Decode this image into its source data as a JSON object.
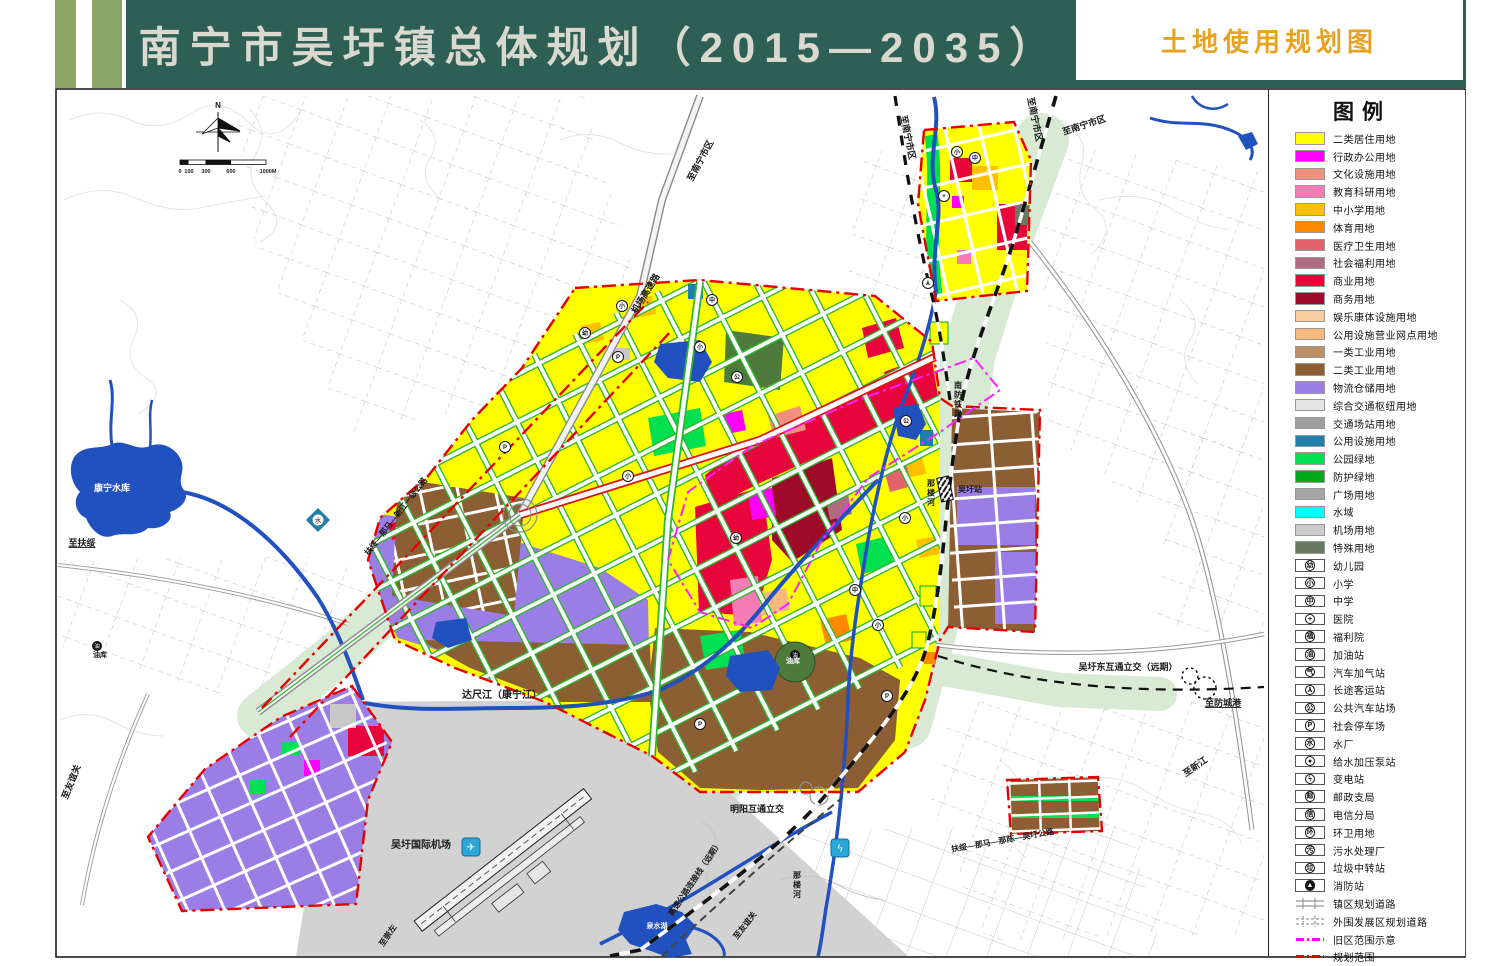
{
  "header": {
    "title": "南宁市吴圩镇总体规划（2015—2035）",
    "sheet_label": "土地使用规划图",
    "bar_color": "#2E5F55",
    "stripe_color": "#8BA566",
    "title_color": "#D9D9CF",
    "sheet_label_color": "#E8A21E"
  },
  "legend": {
    "title": "图例",
    "items": [
      {
        "label": "二类居住用地",
        "color": "#FFFF00"
      },
      {
        "label": "行政办公用地",
        "color": "#FF00FF"
      },
      {
        "label": "文化设施用地",
        "color": "#F0907E"
      },
      {
        "label": "教育科研用地",
        "color": "#F57CB4"
      },
      {
        "label": "中小学用地",
        "color": "#FFC000"
      },
      {
        "label": "体育用地",
        "color": "#FF8A00"
      },
      {
        "label": "医疗卫生用地",
        "color": "#E2636B"
      },
      {
        "label": "社会福利用地",
        "color": "#B26B80"
      },
      {
        "label": "商业用地",
        "color": "#E8053C"
      },
      {
        "label": "商务用地",
        "color": "#9E0B28"
      },
      {
        "label": "娱乐康体设施用地",
        "color": "#F9CD9D"
      },
      {
        "label": "公用设施营业网点用地",
        "color": "#F7B97E"
      },
      {
        "label": "一类工业用地",
        "color": "#BE9066"
      },
      {
        "label": "二类工业用地",
        "color": "#8B5E34"
      },
      {
        "label": "物流仓储用地",
        "color": "#9A7EE6"
      },
      {
        "label": "综合交通枢纽用地",
        "color": "#E4E4E4"
      },
      {
        "label": "交通场站用地",
        "color": "#9E9E9E"
      },
      {
        "label": "公用设施用地",
        "color": "#1F7FA6"
      },
      {
        "label": "公园绿地",
        "color": "#00E050"
      },
      {
        "label": "防护绿地",
        "color": "#00A81C"
      },
      {
        "label": "广场用地",
        "color": "#A6A6A6"
      },
      {
        "label": "水域",
        "color": "#00FFFF"
      },
      {
        "label": "机场用地",
        "color": "#CCCCCC"
      },
      {
        "label": "特殊用地",
        "color": "#6A7A62"
      },
      {
        "label": "幼儿园",
        "glyph": "幼",
        "icon_name": "kindergarten-icon"
      },
      {
        "label": "小学",
        "glyph": "小",
        "icon_name": "primary-school-icon"
      },
      {
        "label": "中学",
        "glyph": "中",
        "icon_name": "middle-school-icon"
      },
      {
        "label": "医院",
        "glyph": "+",
        "icon_name": "hospital-icon"
      },
      {
        "label": "福利院",
        "glyph": "福",
        "icon_name": "welfare-house-icon"
      },
      {
        "label": "加油站",
        "glyph": "油",
        "icon_name": "gas-station-icon"
      },
      {
        "label": "汽车加气站",
        "glyph": "气",
        "icon_name": "cng-station-icon"
      },
      {
        "label": "长途客运站",
        "glyph": "⅄",
        "icon_name": "coach-station-icon"
      },
      {
        "label": "公共汽车站场",
        "glyph": "公",
        "icon_name": "bus-station-icon"
      },
      {
        "label": "社会停车场",
        "glyph": "P",
        "icon_name": "parking-icon"
      },
      {
        "label": "水厂",
        "glyph": "水",
        "icon_name": "water-plant-icon"
      },
      {
        "label": "给水加压泵站",
        "glyph": "●",
        "icon_name": "pump-station-icon"
      },
      {
        "label": "变电站",
        "glyph": "ϟ",
        "icon_name": "substation-icon"
      },
      {
        "label": "邮政支局",
        "glyph": "邮",
        "icon_name": "post-office-icon"
      },
      {
        "label": "电信分局",
        "glyph": "信",
        "icon_name": "telecom-office-icon"
      },
      {
        "label": "环卫用地",
        "glyph": "环",
        "icon_name": "sanitation-icon"
      },
      {
        "label": "污水处理厂",
        "glyph": "污",
        "icon_name": "sewage-plant-icon"
      },
      {
        "label": "垃圾中转站",
        "glyph": "垃",
        "icon_name": "garbage-transfer-icon"
      },
      {
        "label": "消防站",
        "glyph": "▲",
        "style": "filled",
        "icon_name": "fire-station-icon"
      },
      {
        "label": "镇区规划道路",
        "type": "road-solid",
        "icon_name": "town-road-swatch"
      },
      {
        "label": "外围发展区规划道路",
        "type": "road-dashed",
        "icon_name": "outer-road-swatch"
      },
      {
        "label": "旧区范围示意",
        "type": "dashdot",
        "color": "#FF00FF",
        "icon_name": "old-district-line"
      },
      {
        "label": "规划范围",
        "type": "dashdot",
        "color": "#E60000",
        "icon_name": "planning-boundary-line"
      }
    ]
  },
  "map": {
    "labels": [
      {
        "t": "N",
        "x": 218,
        "y": 108,
        "fs": 8,
        "b": 1
      },
      {
        "t": "0",
        "x": 180,
        "y": 173,
        "fs": 5.5
      },
      {
        "t": "100",
        "x": 189,
        "y": 173,
        "fs": 5.5
      },
      {
        "t": "300",
        "x": 206,
        "y": 173,
        "fs": 5.5
      },
      {
        "t": "600",
        "x": 231,
        "y": 173,
        "fs": 5.5
      },
      {
        "t": "1000M",
        "x": 268,
        "y": 173,
        "fs": 5.5
      },
      {
        "t": "至南宁市区",
        "x": 703,
        "y": 162,
        "rot": -62,
        "fs": 9
      },
      {
        "t": "至南宁市区",
        "x": 905,
        "y": 138,
        "rot": 78,
        "fs": 9
      },
      {
        "t": "至南宁市区",
        "x": 1032,
        "y": 120,
        "rot": 78,
        "fs": 9
      },
      {
        "t": "至南宁市区",
        "x": 1085,
        "y": 128,
        "rot": -18,
        "fs": 9
      },
      {
        "t": "机场高速路",
        "x": 648,
        "y": 295,
        "rot": -58,
        "fs": 9
      },
      {
        "t": "至扶绥",
        "x": 82,
        "y": 546,
        "fs": 9,
        "ul": 1
      },
      {
        "t": "康宁水库",
        "x": 112,
        "y": 491,
        "fs": 9,
        "fill": "#ffffff"
      },
      {
        "t": "油库",
        "x": 100,
        "y": 657,
        "fs": 7
      },
      {
        "t": "油库",
        "x": 793,
        "y": 663,
        "fs": 7,
        "fill": "#ffffff"
      },
      {
        "t": "至友谊关",
        "x": 74,
        "y": 783,
        "rot": -68,
        "fs": 9
      },
      {
        "t": "至友谊关",
        "x": 747,
        "y": 927,
        "rot": -52,
        "fs": 8
      },
      {
        "t": "达尺江（康宁江）",
        "x": 502,
        "y": 698,
        "fs": 10
      },
      {
        "t": "吴圩国际机场",
        "x": 421,
        "y": 848,
        "fs": 10
      },
      {
        "t": "吴圩站",
        "x": 970,
        "y": 492,
        "fs": 8
      },
      {
        "t": "南防铁路",
        "x": 958,
        "y": 388,
        "v": 1,
        "fs": 8
      },
      {
        "t": "那楼河",
        "x": 931,
        "y": 486,
        "v": 1,
        "fs": 8
      },
      {
        "t": "那楼河",
        "x": 797,
        "y": 878,
        "v": 1,
        "fs": 8
      },
      {
        "t": "吴圩东互通立交（远期）",
        "x": 1128,
        "y": 670,
        "fs": 9
      },
      {
        "t": "至防城港",
        "x": 1223,
        "y": 706,
        "fs": 9,
        "ul": 1
      },
      {
        "t": "至新江",
        "x": 1197,
        "y": 769,
        "rot": -35,
        "fs": 9
      },
      {
        "t": "明阳互通立交",
        "x": 757,
        "y": 812,
        "fs": 9
      },
      {
        "t": "高速公路连接线（远期）",
        "x": 697,
        "y": 880,
        "rot": -56,
        "fs": 8
      },
      {
        "t": "扶绥—那马—新江一级公路",
        "x": 398,
        "y": 518,
        "rot": -52,
        "fs": 8
      },
      {
        "t": "扶绥—那马—那陈—吴圩公路",
        "x": 1003,
        "y": 843,
        "rot": -10,
        "fs": 8
      },
      {
        "t": "至崇左",
        "x": 390,
        "y": 937,
        "rot": -56,
        "fs": 8
      },
      {
        "t": "泉水湖",
        "x": 657,
        "y": 928,
        "fs": 7,
        "fill": "#ffffff"
      }
    ],
    "icons": [
      {
        "g": "幼",
        "x": 585,
        "y": 333,
        "n": "kindergarten-icon"
      },
      {
        "g": "小",
        "x": 622,
        "y": 306,
        "n": "primary-school-icon"
      },
      {
        "g": "中",
        "x": 712,
        "y": 300,
        "n": "middle-school-icon"
      },
      {
        "g": "小",
        "x": 700,
        "y": 347,
        "n": "primary-school-icon"
      },
      {
        "g": "公",
        "x": 737,
        "y": 377,
        "n": "bus-station-icon"
      },
      {
        "g": "P",
        "x": 618,
        "y": 357,
        "n": "parking-icon"
      },
      {
        "g": "P",
        "x": 505,
        "y": 447,
        "n": "parking-icon"
      },
      {
        "g": "小",
        "x": 628,
        "y": 476,
        "n": "primary-school-icon"
      },
      {
        "g": "幼",
        "x": 736,
        "y": 538,
        "n": "kindergarten-icon"
      },
      {
        "g": "中",
        "x": 855,
        "y": 590,
        "n": "middle-school-icon"
      },
      {
        "g": "小",
        "x": 905,
        "y": 518,
        "n": "primary-school-icon"
      },
      {
        "g": "小",
        "x": 878,
        "y": 625,
        "n": "primary-school-icon"
      },
      {
        "g": "P",
        "x": 700,
        "y": 724,
        "n": "parking-icon"
      },
      {
        "g": "P",
        "x": 887,
        "y": 696,
        "n": "parking-icon"
      },
      {
        "g": "公",
        "x": 906,
        "y": 421,
        "n": "bus-station-icon"
      },
      {
        "g": "+",
        "x": 944,
        "y": 196,
        "n": "hospital-icon"
      },
      {
        "g": "小",
        "x": 957,
        "y": 152,
        "n": "primary-school-icon"
      },
      {
        "g": "中",
        "x": 975,
        "y": 158,
        "n": "middle-school-icon"
      },
      {
        "g": "⅄",
        "x": 928,
        "y": 283,
        "n": "coach-station-icon"
      },
      {
        "g": "油",
        "x": 795,
        "y": 655,
        "st": "f",
        "n": "oil-depot-icon"
      },
      {
        "g": "油",
        "x": 97,
        "y": 646,
        "st": "f",
        "n": "oil-depot-icon"
      },
      {
        "g": "水",
        "x": 318,
        "y": 520,
        "st": "d",
        "n": "water-plant-icon"
      },
      {
        "g": "ϟ",
        "x": 840,
        "y": 848,
        "st": "sq",
        "n": "substation-icon"
      },
      {
        "g": "✈",
        "x": 471,
        "y": 847,
        "st": "sq",
        "n": "airport-icon"
      }
    ]
  }
}
